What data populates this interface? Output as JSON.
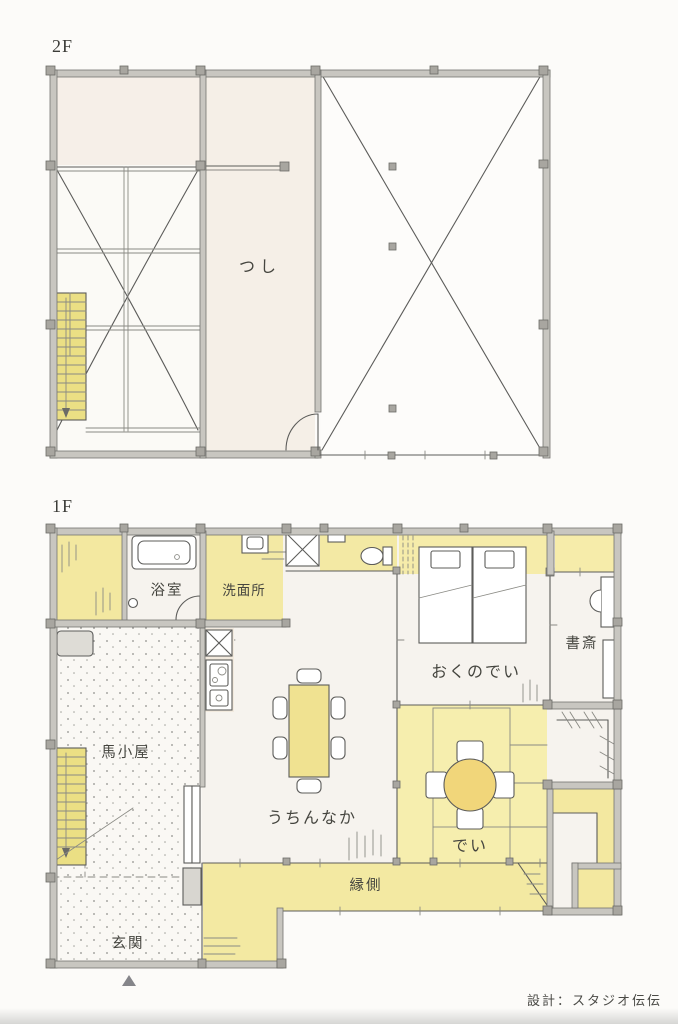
{
  "credit": "設計：スタジオ伝伝",
  "floor2": {
    "label": "2F",
    "rooms": {
      "tsushi": "つし"
    }
  },
  "floor1": {
    "label": "1F",
    "rooms": {
      "bathroom": "浴室",
      "washroom": "洗面所",
      "okunodei": "おくのでい",
      "study": "書斎",
      "stable": "馬小屋",
      "uchinnaka": "うちんなか",
      "dei": "でい",
      "engawa": "縁側",
      "entrance": "玄関"
    }
  },
  "colors": {
    "paper": "#fcfbf9",
    "wall": "#c8c6c0",
    "room_shade": "#f5efe7",
    "highlight_yellow": "#f3e8a0",
    "stairs_yellow": "#ebdf84",
    "dei_yellow": "#f6eeae",
    "table_yellow": "#f1d67a",
    "ink": "#55555a"
  }
}
